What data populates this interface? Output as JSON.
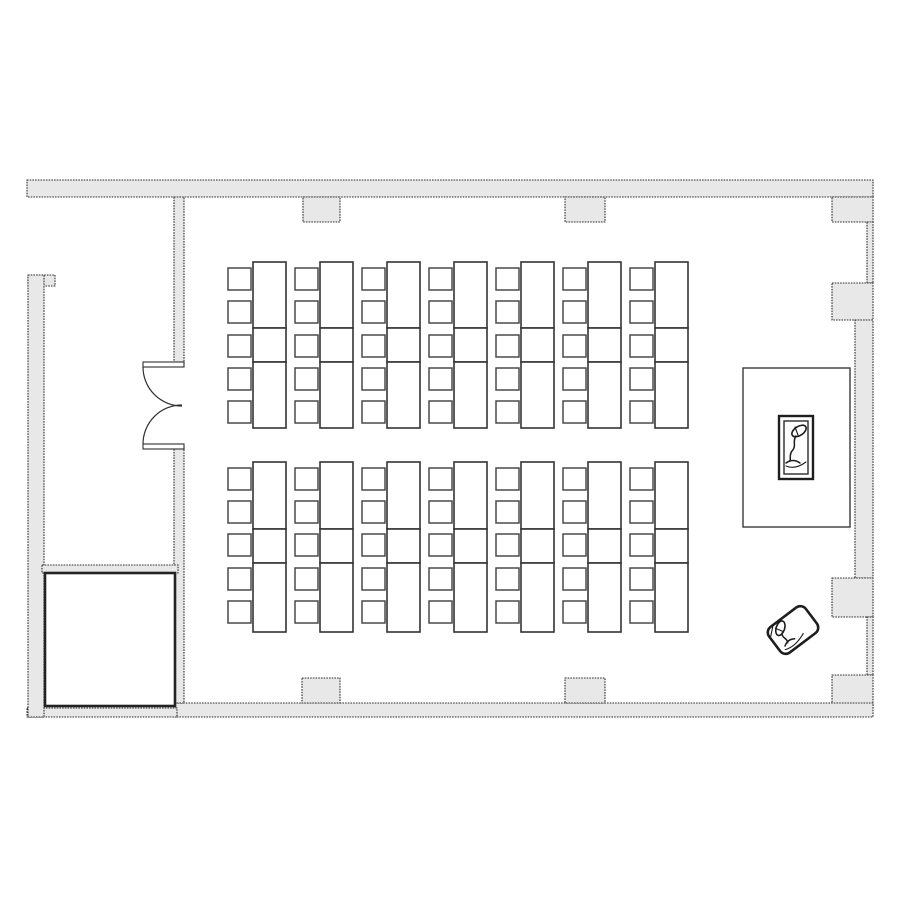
{
  "meta": {
    "title": "Classroom floor plan",
    "canvas": {
      "width": 900,
      "height": 900
    }
  },
  "colors": {
    "background": "#ffffff",
    "wall_fill": "#e8e8e8",
    "wall_stroke": "#2e2e2e",
    "furniture_fill": "#ffffff"
  },
  "icons": {
    "lectern": "microphone-icon",
    "portable_lectern": "microphone-icon"
  },
  "floorplan": {
    "walls": [
      {
        "name": "top-wall",
        "x": 27,
        "y": 180,
        "w": 846,
        "h": 17
      },
      {
        "name": "top-pilaster-left",
        "x": 303,
        "y": 197,
        "w": 37,
        "h": 25
      },
      {
        "name": "top-pilaster-right",
        "x": 565,
        "y": 197,
        "w": 40,
        "h": 25
      },
      {
        "name": "ne-corner-pilaster",
        "x": 832,
        "y": 197,
        "w": 41,
        "h": 25
      },
      {
        "name": "right-wall-window-upper",
        "x": 867,
        "y": 222,
        "w": 6,
        "h": 61
      },
      {
        "name": "right-pilaster-upper",
        "x": 832,
        "y": 283,
        "w": 41,
        "h": 37
      },
      {
        "name": "right-wall-middle",
        "x": 855,
        "y": 320,
        "w": 18,
        "h": 258
      },
      {
        "name": "right-pilaster-lower",
        "x": 832,
        "y": 578,
        "w": 41,
        "h": 39
      },
      {
        "name": "right-wall-window-lower",
        "x": 867,
        "y": 617,
        "w": 6,
        "h": 58
      },
      {
        "name": "se-corner-pilaster",
        "x": 832,
        "y": 675,
        "w": 41,
        "h": 32
      },
      {
        "name": "bottom-wall",
        "x": 175,
        "y": 703,
        "w": 698,
        "h": 14
      },
      {
        "name": "bottom-pilaster-left",
        "x": 302,
        "y": 678,
        "w": 38,
        "h": 25
      },
      {
        "name": "bottom-pilaster-right",
        "x": 565,
        "y": 678,
        "w": 40,
        "h": 25
      },
      {
        "name": "bottom-wall-left",
        "x": 27,
        "y": 708,
        "w": 150,
        "h": 9
      },
      {
        "name": "left-wall-tab",
        "x": 28,
        "y": 275,
        "w": 27,
        "h": 11
      },
      {
        "name": "left-wall",
        "x": 28,
        "y": 275,
        "w": 16,
        "h": 442
      },
      {
        "name": "vestibule-wall-upper",
        "x": 174,
        "y": 197,
        "w": 10,
        "h": 169
      },
      {
        "name": "vestibule-wall-lower",
        "x": 174,
        "y": 446,
        "w": 10,
        "h": 257
      },
      {
        "name": "vestibule-divider-wall",
        "x": 42,
        "y": 565,
        "w": 136,
        "h": 8
      }
    ],
    "storage_room": {
      "x": 45,
      "y": 573,
      "w": 130,
      "h": 133
    },
    "door": {
      "type": "double-swing",
      "leaves": [
        {
          "x": 143,
          "y": 362,
          "w": 41,
          "h": 5
        },
        {
          "x": 143,
          "y": 444,
          "w": 41,
          "h": 5
        }
      ],
      "arcs": [
        "M 143 367 A 39 39 0 0 0 182 406",
        "M 143 444 A 39 39 0 0 1 182 405"
      ]
    },
    "desk_blocks": [
      {
        "name": "front-desk-block",
        "column_xs": [
          228,
          295,
          362,
          429,
          496,
          563,
          630
        ],
        "chair_w": 23,
        "chair_h": 22,
        "desk_offset": 25,
        "desk_w": 33,
        "desk_rows": [
          {
            "y": 262,
            "h": 66
          },
          {
            "y": 328,
            "h": 34
          },
          {
            "y": 362,
            "h": 66
          }
        ],
        "chair_ys": [
          268,
          301,
          335,
          368,
          401
        ]
      },
      {
        "name": "rear-desk-block",
        "column_xs": [
          228,
          295,
          362,
          429,
          496,
          563,
          630
        ],
        "chair_w": 23,
        "chair_h": 22,
        "desk_offset": 25,
        "desk_w": 33,
        "desk_rows": [
          {
            "y": 462,
            "h": 67
          },
          {
            "y": 529,
            "h": 34
          },
          {
            "y": 563,
            "h": 69
          }
        ],
        "chair_ys": [
          468,
          501,
          534,
          568,
          601
        ]
      }
    ],
    "platform": {
      "x": 743,
      "y": 368,
      "w": 107,
      "h": 159
    },
    "lectern": {
      "outer": {
        "x": 779,
        "y": 416,
        "w": 34,
        "h": 63
      },
      "inner": {
        "x": 784,
        "y": 421,
        "w": 24,
        "h": 53
      }
    },
    "tilted_lectern": {
      "cx": 793,
      "cy": 630,
      "w": 46,
      "h": 32,
      "rx": 7,
      "rotation": -37
    }
  }
}
